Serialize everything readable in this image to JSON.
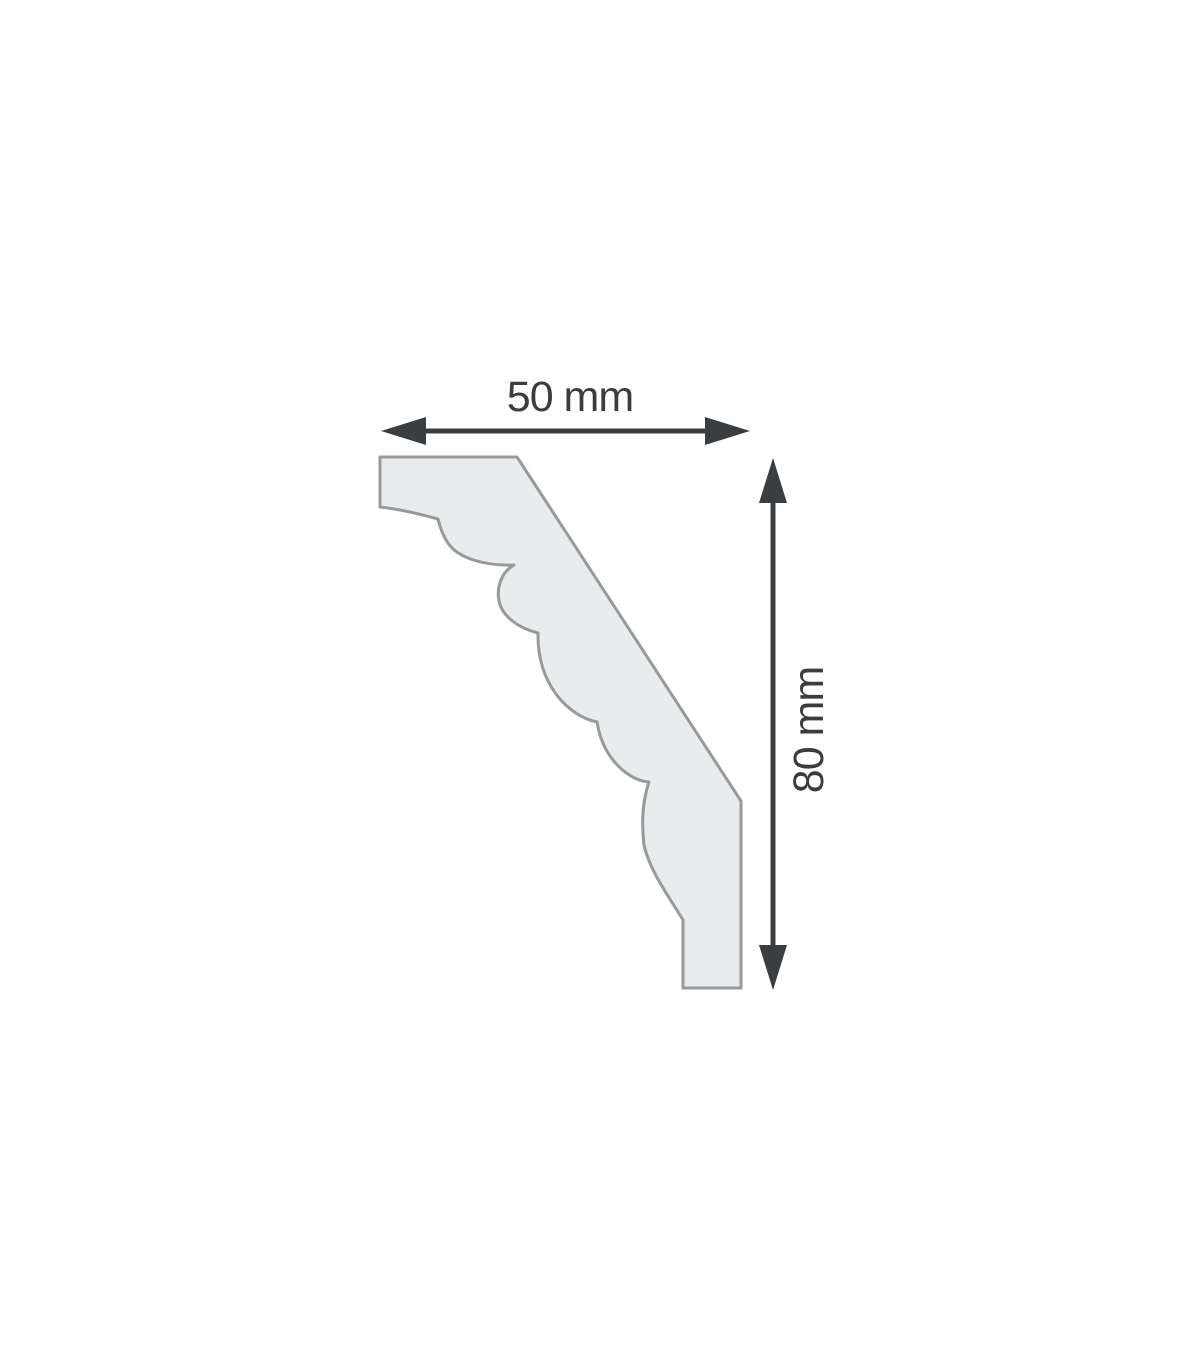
{
  "diagram": {
    "type": "molding-profile-cross-section-drawing",
    "width_label": "50 mm",
    "height_label": "80 mm",
    "width_value_mm": 50,
    "height_value_mm": 80
  },
  "colors": {
    "background": "#ffffff",
    "profile_fill": "#e8eced",
    "profile_stroke": "#97999a",
    "dimension_color": "#3a3e41",
    "label_color": "#3c3c3e"
  }
}
